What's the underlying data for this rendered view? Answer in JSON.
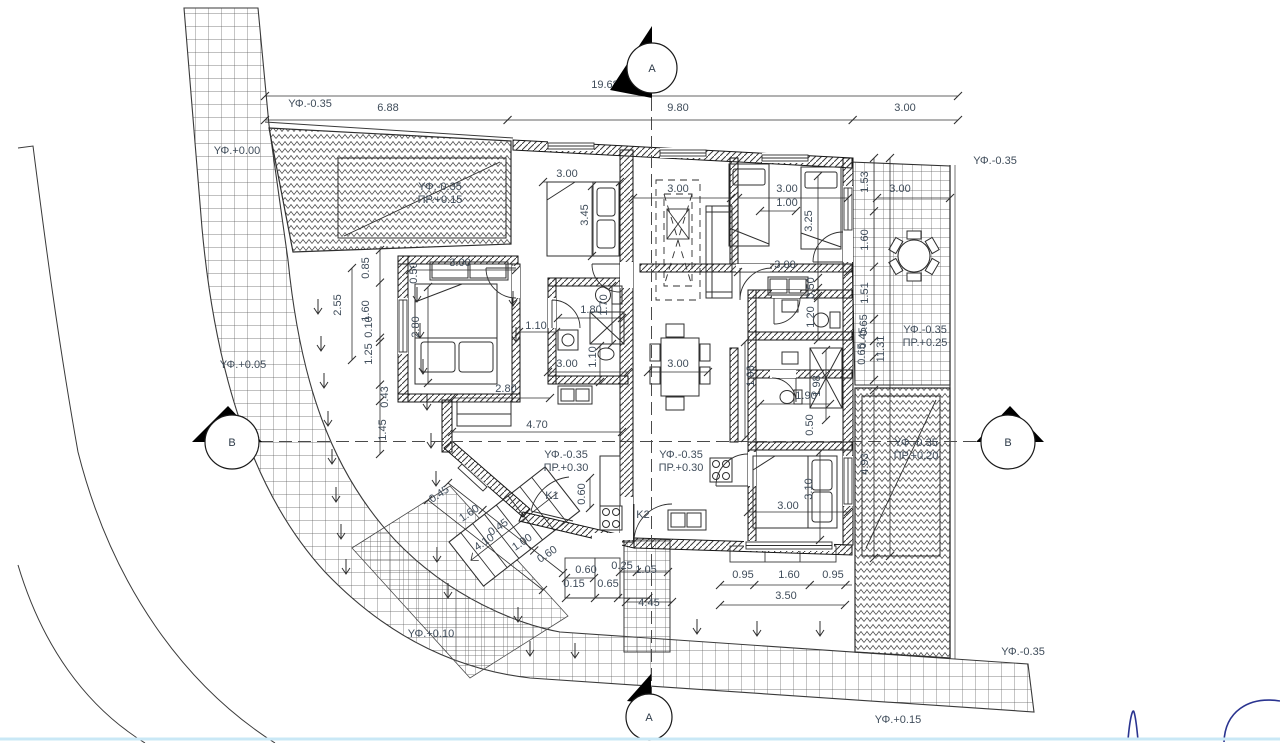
{
  "colors": {
    "line": "#2f2f2f",
    "text": "#3f4c5a",
    "pen_blue": "#2a3490",
    "viewport_edge": "#c9e8f6",
    "paper": "#ffffff"
  },
  "dimension_labels": [
    [
      "19.68",
      605,
      88,
      0
    ],
    [
      "6.88",
      388,
      111,
      0
    ],
    [
      "9.80",
      678,
      111,
      0
    ],
    [
      "3.00",
      905,
      111,
      0
    ],
    [
      "3.00",
      460,
      266,
      0
    ],
    [
      "0.50",
      417,
      273,
      -90
    ],
    [
      "3.00",
      567,
      177,
      0
    ],
    [
      "3.45",
      588,
      215,
      -90
    ],
    [
      "3.00",
      678,
      192,
      0
    ],
    [
      "3.00",
      787,
      192,
      0
    ],
    [
      "1.00",
      787,
      206,
      0
    ],
    [
      "3.25",
      812,
      221,
      -90
    ],
    [
      "1.53",
      868,
      182,
      -90
    ],
    [
      "3.00",
      900,
      192,
      0
    ],
    [
      "1.60",
      868,
      240,
      -90
    ],
    [
      "1.51",
      868,
      293,
      -90
    ],
    [
      "0.65",
      867,
      325,
      -90
    ],
    [
      "0.45",
      866,
      338,
      -90
    ],
    [
      "0.65",
      865,
      354,
      -90
    ],
    [
      "11.31",
      884,
      349,
      -90
    ],
    [
      "3.00",
      785,
      268,
      0
    ],
    [
      "0.50",
      814,
      288,
      -90
    ],
    [
      "1.20",
      814,
      317,
      -90
    ],
    [
      "2.55",
      341,
      305,
      -90
    ],
    [
      "1.60",
      369,
      311,
      -90
    ],
    [
      "0.85",
      369,
      268,
      -90
    ],
    [
      "0.10",
      372,
      327,
      -90
    ],
    [
      "1.25",
      372,
      354,
      -90
    ],
    [
      "0.43",
      388,
      397,
      -90
    ],
    [
      "1.45",
      386,
      430,
      -90
    ],
    [
      "2.80",
      419,
      327,
      -90
    ],
    [
      "1.10",
      536,
      329,
      0
    ],
    [
      "1.80",
      591,
      313,
      0
    ],
    [
      "1.70",
      607,
      305,
      -90
    ],
    [
      "1.10",
      596,
      357,
      -90
    ],
    [
      "3.00",
      567,
      367,
      0
    ],
    [
      "2.80",
      506,
      392,
      0
    ],
    [
      "4.70",
      537,
      428,
      0
    ],
    [
      "3.00",
      678,
      367,
      0
    ],
    [
      "1.98",
      754,
      376,
      -90
    ],
    [
      "1.90",
      806,
      399,
      0
    ],
    [
      "1.98",
      820,
      386,
      -90
    ],
    [
      "0.50",
      813,
      425,
      -90
    ],
    [
      "3.00",
      788,
      509,
      0
    ],
    [
      "3.10",
      812,
      489,
      -90
    ],
    [
      "4.93",
      868,
      464,
      -90
    ],
    [
      "0.60",
      585,
      494,
      -90
    ],
    [
      "0.45",
      441,
      497,
      -34
    ],
    [
      "1.60",
      471,
      516,
      -34
    ],
    [
      "0.45",
      500,
      530,
      -34
    ],
    [
      "4.10",
      486,
      545,
      -34
    ],
    [
      "1.00",
      524,
      545,
      -34
    ],
    [
      "0.60",
      549,
      557,
      -34
    ],
    [
      "0.60",
      586,
      573,
      0
    ],
    [
      "0.15",
      574,
      587,
      0
    ],
    [
      "0.65",
      608,
      587,
      0
    ],
    [
      "0.25",
      622,
      569,
      0
    ],
    [
      "1.05",
      646,
      573,
      0
    ],
    [
      "4.45",
      649,
      606,
      0
    ],
    [
      "0.95",
      743,
      578,
      0
    ],
    [
      "1.60",
      789,
      578,
      0
    ],
    [
      "0.95",
      833,
      578,
      0
    ],
    [
      "3.50",
      786,
      599,
      0
    ]
  ],
  "elevation_labels": [
    [
      "ΥΦ.+0.00",
      237,
      154
    ],
    [
      "ΥΦ.-0.35",
      310,
      107
    ],
    [
      "ΥΦ.-0.35",
      440,
      190
    ],
    [
      "ΠΡ.+0.15",
      440,
      203
    ],
    [
      "ΥΦ.-0.35",
      995,
      164
    ],
    [
      "ΥΦ.-0.35",
      925,
      333
    ],
    [
      "ΠΡ.+0.25",
      925,
      346
    ],
    [
      "ΥΦ.+0.05",
      243,
      368
    ],
    [
      "ΥΦ.-0.35",
      566,
      458
    ],
    [
      "ΠΡ.+0.30",
      566,
      471
    ],
    [
      "ΥΦ.-0.35",
      681,
      458
    ],
    [
      "ΠΡ.+0.30",
      681,
      471
    ],
    [
      "ΥΦ.-0.35",
      916,
      446
    ],
    [
      "ΠΡ.+0.20",
      916,
      459
    ],
    [
      "ΥΦ.+0.10",
      431,
      637
    ],
    [
      "ΥΦ.-0.35",
      1023,
      655
    ],
    [
      "ΥΦ.+0.15",
      898,
      723
    ]
  ],
  "room_labels": [
    [
      "K1",
      552,
      499
    ],
    [
      "K2",
      643,
      518
    ]
  ],
  "section_markers": [
    {
      "letter": "A",
      "cx": 652,
      "cy": 68,
      "r": 25,
      "tri": "652,26 652,98 610,90"
    },
    {
      "letter": "B",
      "cx": 232,
      "cy": 442,
      "r": 27,
      "tri": "192,442 262,442 228,406"
    },
    {
      "letter": "B",
      "cx": 1008,
      "cy": 442,
      "r": 27,
      "tri": "976,442 1044,442 1010,406"
    },
    {
      "letter": "A",
      "cx": 649,
      "cy": 717,
      "r": 23,
      "tri": "651,674 651,704 627,701"
    }
  ],
  "slope_arrows": [
    [
      318,
      308
    ],
    [
      321,
      345
    ],
    [
      324,
      382
    ],
    [
      328,
      420
    ],
    [
      332,
      458
    ],
    [
      336,
      496
    ],
    [
      341,
      533
    ],
    [
      346,
      568
    ],
    [
      417,
      296
    ],
    [
      420,
      332
    ],
    [
      423,
      368
    ],
    [
      427,
      404
    ],
    [
      431,
      442
    ],
    [
      436,
      480
    ],
    [
      513,
      300
    ],
    [
      516,
      336
    ],
    [
      437,
      556
    ],
    [
      448,
      592
    ],
    [
      518,
      616
    ],
    [
      530,
      650
    ],
    [
      575,
      652
    ],
    [
      697,
      628
    ],
    [
      757,
      630
    ],
    [
      820,
      630
    ]
  ],
  "dimension_lines": [
    [
      265,
      96,
      958,
      96,
      [
        0,
        1
      ]
    ],
    [
      265,
      120,
      958,
      120,
      [
        0,
        0.35,
        0.848,
        1
      ]
    ],
    [
      410,
      270,
      516,
      270,
      [
        0,
        1
      ]
    ],
    [
      543,
      182,
      620,
      182,
      [
        0,
        1
      ]
    ],
    [
      592,
      186,
      592,
      256,
      [
        0,
        1
      ]
    ],
    [
      633,
      198,
      731,
      198,
      [
        0,
        1
      ]
    ],
    [
      738,
      198,
      848,
      198,
      [
        0,
        1
      ]
    ],
    [
      760,
      211,
      796,
      211,
      [
        0,
        1
      ]
    ],
    [
      818,
      176,
      818,
      288,
      [
        0,
        1
      ]
    ],
    [
      874,
      158,
      874,
      380,
      [
        0,
        0.24,
        0.49,
        0.725,
        0.824,
        0.896,
        1
      ]
    ],
    [
      877,
      198,
      950,
      198,
      [
        0,
        1
      ]
    ],
    [
      890,
      158,
      890,
      556,
      [
        0,
        1
      ]
    ],
    [
      738,
      272,
      848,
      272,
      [
        0,
        1
      ]
    ],
    [
      818,
      278,
      818,
      296,
      [
        0,
        1
      ]
    ],
    [
      818,
      298,
      818,
      340,
      [
        0,
        1
      ]
    ],
    [
      352,
      268,
      352,
      360,
      [
        0,
        1
      ]
    ],
    [
      380,
      250,
      380,
      454,
      [
        0,
        0.16,
        0.43,
        0.45,
        0.66,
        0.74,
        1
      ]
    ],
    [
      428,
      287,
      428,
      383,
      [
        0,
        1
      ]
    ],
    [
      519,
      332,
      556,
      332,
      [
        0,
        1
      ]
    ],
    [
      558,
      318,
      622,
      318,
      [
        0,
        1
      ]
    ],
    [
      612,
      286,
      612,
      344,
      [
        0,
        1
      ]
    ],
    [
      600,
      346,
      600,
      382,
      [
        0,
        1
      ]
    ],
    [
      548,
      372,
      628,
      372,
      [
        0,
        1
      ]
    ],
    [
      452,
      398,
      550,
      398,
      [
        0,
        1
      ]
    ],
    [
      452,
      432,
      622,
      432,
      [
        0,
        1
      ]
    ],
    [
      648,
      372,
      708,
      372,
      [
        0,
        1
      ]
    ],
    [
      745,
      342,
      745,
      438,
      [
        0,
        1
      ]
    ],
    [
      760,
      404,
      830,
      404,
      [
        0,
        1
      ]
    ],
    [
      826,
      350,
      826,
      420,
      [
        0,
        1
      ]
    ],
    [
      748,
      512,
      848,
      512,
      [
        0,
        1
      ]
    ],
    [
      820,
      452,
      820,
      540,
      [
        0,
        1
      ]
    ],
    [
      874,
      390,
      874,
      558,
      [
        0,
        1
      ]
    ],
    [
      590,
      478,
      590,
      508,
      [
        0,
        1
      ]
    ],
    [
      566,
      578,
      594,
      578,
      [
        0,
        1
      ]
    ],
    [
      566,
      598,
      650,
      598,
      [
        0,
        0.345,
        0.62,
        0.98
      ]
    ],
    [
      620,
      572,
      668,
      572,
      [
        0,
        0.35,
        1
      ]
    ],
    [
      626,
      602,
      672,
      602,
      [
        0,
        1
      ]
    ],
    [
      720,
      585,
      852,
      585,
      [
        0,
        0.26,
        0.68,
        0.95
      ]
    ],
    [
      720,
      605,
      845,
      605,
      [
        0,
        1
      ]
    ],
    [
      428,
      500,
      543,
      590,
      [
        0,
        1
      ]
    ],
    [
      448,
      483,
      563,
      573,
      [
        0,
        0.3,
        0.75,
        1
      ]
    ]
  ]
}
